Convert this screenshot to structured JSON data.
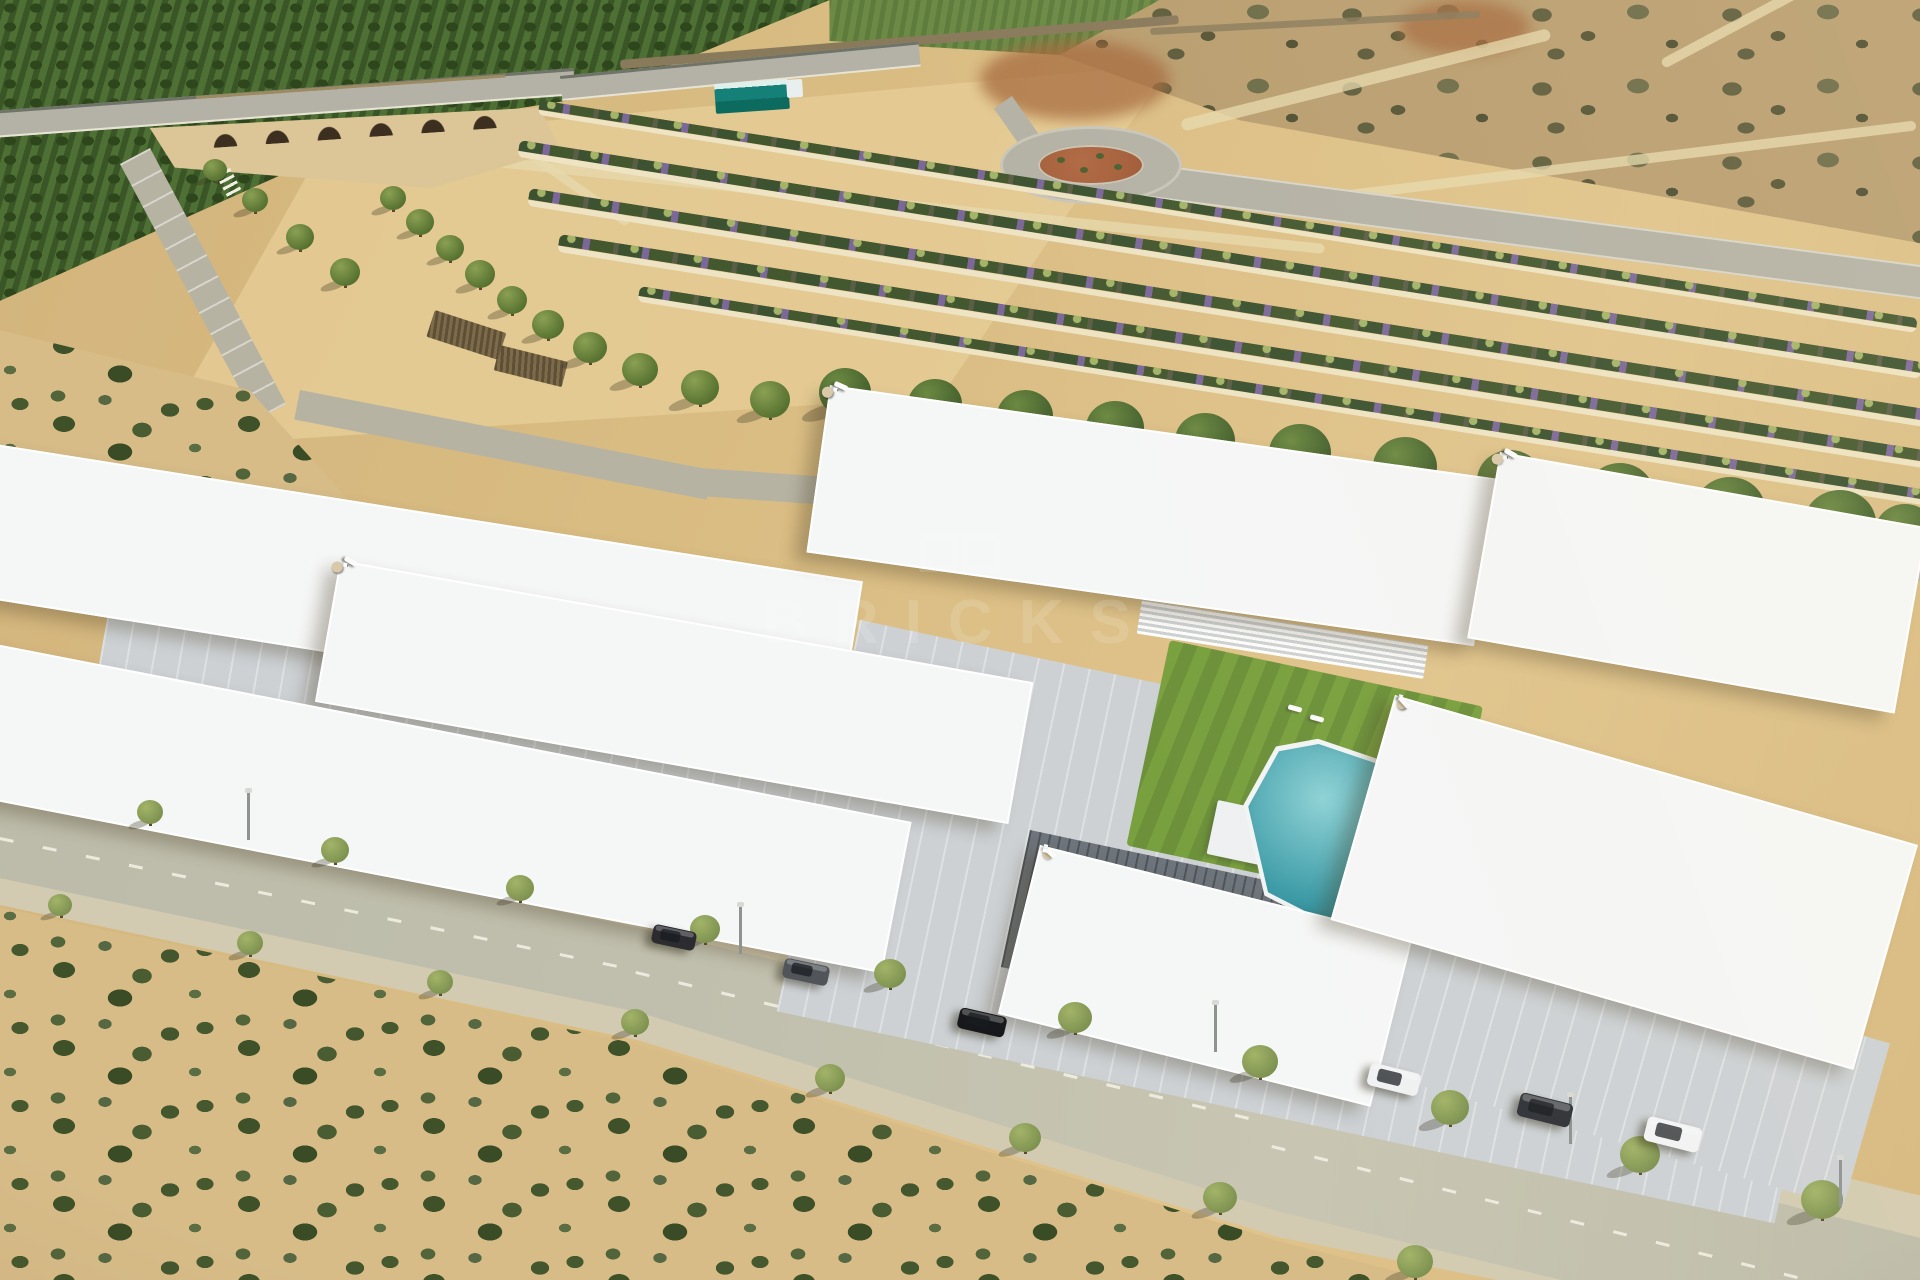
{
  "scene": {
    "type": "aerial-architectural-render",
    "description": "Aerial 3D render of a new-build white residential complex with roof terraces, communal teal pool and lawn, a tree-lined avenue with parked cars in front, sandy scrubland foreground, plowed tan fields, rows of purple flowering shrubs, an orchard hillside, a stone arched bridge and a roundabout in the background."
  },
  "watermark": {
    "text": "BRICKS"
  },
  "palette": {
    "field": "#d9bc82",
    "fieldLight": "#e6cd96",
    "trackPale": "#e7d9ae",
    "roadGray": "#b4b2a6",
    "roadAvenue": "#b6b3a3",
    "roadC": "#c0bfad",
    "sidewalk": "#d3cbb1",
    "guard": "#6f7368",
    "orchardDark": "#3a5526",
    "orchardMid": "#4f7034",
    "orchardLight": "#6c8a46",
    "scrubSand": "#d7bc88",
    "scrubBush": "#46582e",
    "drySand": "#b99e70",
    "dryBush": "#5f5e3d",
    "pine": "#44602e",
    "pineLight": "#6d8a42",
    "treeCanopy": "#7d9150",
    "treeCanopyLight": "#a3b468",
    "trunk": "#5d4a2e",
    "bwhite": "#f5f6f6",
    "roofMid": "#cdd4d9",
    "wellDark": "#747d85",
    "glass": "#414a51",
    "wood": "#a87c45",
    "parasol": "#d9c9a8",
    "poolTeal": "#3b9aa6",
    "poolTealLight": "#8ed2d6",
    "lawn": "#79a03e",
    "lawnDark": "#6c913a",
    "terracotta": "#a05a38",
    "redEarth": "#a66a3e",
    "tealDepot": "#158077",
    "stoneWall": "#8a7a5c",
    "bridge": "#c2a36b",
    "arch": "#3d2f1f",
    "ravine": "#dcc697",
    "shrubGreen": "#3c5230",
    "shrubPurple": "#7c6898",
    "pathCream": "#eee3c2"
  },
  "objects": {
    "building_rows": [
      {
        "x": -30,
        "y": 440,
        "w": 900,
        "h": 150,
        "rot": 9,
        "units": 8,
        "type": "facade"
      },
      {
        "x": 340,
        "y": 560,
        "w": 700,
        "h": 140,
        "rot": 10,
        "units": 6,
        "type": "roof"
      },
      {
        "x": -25,
        "y": 640,
        "w": 950,
        "h": 150,
        "rot": 11,
        "units": 8,
        "type": "facade"
      },
      {
        "x": 830,
        "y": 385,
        "w": 670,
        "h": 165,
        "rot": 8,
        "units": 6,
        "type": "roof"
      },
      {
        "x": 1500,
        "y": 452,
        "w": 430,
        "h": 185,
        "rot": 10,
        "units": 4,
        "type": "roof"
      },
      {
        "x": 1040,
        "y": 845,
        "w": 380,
        "h": 170,
        "rot": 14,
        "units": 3,
        "type": "facade"
      },
      {
        "x": 1395,
        "y": 695,
        "w": 540,
        "h": 230,
        "rot": 16,
        "units": 5,
        "type": "facade"
      }
    ],
    "paved": [
      {
        "x": 120,
        "y": 545,
        "w": 760,
        "h": 250,
        "rot": 10,
        "shade": "light"
      },
      {
        "x": 860,
        "y": 620,
        "w": 1020,
        "h": 400,
        "rot": 12,
        "shade": "light"
      },
      {
        "x": 1390,
        "y": 900,
        "w": 520,
        "h": 170,
        "rot": 16,
        "shade": "light"
      },
      {
        "x": 1030,
        "y": 830,
        "w": 300,
        "h": 140,
        "rot": 12,
        "shade": "dark"
      }
    ],
    "lawns": [
      {
        "x": 1170,
        "y": 640,
        "w": 320,
        "h": 210,
        "rot": 12
      }
    ],
    "fences": [
      {
        "x": 1142,
        "y": 600,
        "w": 290,
        "h": 34,
        "rot": 9
      }
    ],
    "platforms": [
      {
        "x": 1218,
        "y": 800,
        "w": 85,
        "h": 55,
        "rot": 12
      }
    ],
    "pools": [
      {
        "x": 1257,
        "y": 728,
        "w": 182,
        "h": 186,
        "rot": 10
      }
    ],
    "pool_loungers": [
      {
        "x": 1288,
        "y": 706,
        "rot": 15
      },
      {
        "x": 1310,
        "y": 716,
        "rot": 15
      },
      {
        "x": 1424,
        "y": 724,
        "rot": 15
      },
      {
        "x": 1450,
        "y": 736,
        "rot": 15
      }
    ],
    "shrub_rows": [
      {
        "x": 540,
        "y": 100,
        "len": 1395,
        "h": 15,
        "rot": 9
      },
      {
        "x": 520,
        "y": 140,
        "len": 1420,
        "h": 17,
        "rot": 9
      },
      {
        "x": 530,
        "y": 188,
        "len": 1420,
        "h": 18,
        "rot": 9
      },
      {
        "x": 560,
        "y": 234,
        "len": 1400,
        "h": 18,
        "rot": 9
      },
      {
        "x": 640,
        "y": 286,
        "len": 1320,
        "h": 16,
        "rot": 9
      }
    ],
    "pines": [
      {
        "x": 845,
        "y": 392,
        "r": 26
      },
      {
        "x": 935,
        "y": 404,
        "r": 27
      },
      {
        "x": 1025,
        "y": 416,
        "r": 28
      },
      {
        "x": 1115,
        "y": 428,
        "r": 29
      },
      {
        "x": 1205,
        "y": 441,
        "r": 30
      },
      {
        "x": 1300,
        "y": 453,
        "r": 31
      },
      {
        "x": 1405,
        "y": 467,
        "r": 32
      },
      {
        "x": 1510,
        "y": 481,
        "r": 33
      },
      {
        "x": 1620,
        "y": 495,
        "r": 34
      },
      {
        "x": 1730,
        "y": 509,
        "r": 35
      },
      {
        "x": 1840,
        "y": 523,
        "r": 36
      },
      {
        "x": 1905,
        "y": 532,
        "r": 30
      }
    ],
    "field_trees": [
      {
        "x": 215,
        "y": 170,
        "r": 12
      },
      {
        "x": 255,
        "y": 200,
        "r": 13
      },
      {
        "x": 300,
        "y": 237,
        "r": 14
      },
      {
        "x": 345,
        "y": 272,
        "r": 15
      },
      {
        "x": 393,
        "y": 198,
        "r": 13
      },
      {
        "x": 420,
        "y": 222,
        "r": 14
      },
      {
        "x": 450,
        "y": 248,
        "r": 14
      },
      {
        "x": 480,
        "y": 274,
        "r": 15
      },
      {
        "x": 512,
        "y": 300,
        "r": 15
      },
      {
        "x": 548,
        "y": 325,
        "r": 16
      },
      {
        "x": 590,
        "y": 348,
        "r": 17
      },
      {
        "x": 640,
        "y": 370,
        "r": 18
      },
      {
        "x": 700,
        "y": 388,
        "r": 19
      },
      {
        "x": 770,
        "y": 400,
        "r": 20
      }
    ],
    "street_trees": [
      {
        "x": 150,
        "y": 812,
        "r": 13
      },
      {
        "x": 335,
        "y": 850,
        "r": 14
      },
      {
        "x": 520,
        "y": 888,
        "r": 14
      },
      {
        "x": 705,
        "y": 929,
        "r": 15
      },
      {
        "x": 890,
        "y": 974,
        "r": 16
      },
      {
        "x": 1075,
        "y": 1018,
        "r": 17
      },
      {
        "x": 1260,
        "y": 1062,
        "r": 18
      },
      {
        "x": 1450,
        "y": 1108,
        "r": 19
      },
      {
        "x": 1640,
        "y": 1155,
        "r": 20
      },
      {
        "x": 1822,
        "y": 1200,
        "r": 21
      },
      {
        "x": 60,
        "y": 905,
        "r": 12
      },
      {
        "x": 250,
        "y": 943,
        "r": 13
      },
      {
        "x": 440,
        "y": 982,
        "r": 13
      },
      {
        "x": 635,
        "y": 1022,
        "r": 14
      },
      {
        "x": 830,
        "y": 1078,
        "r": 15
      },
      {
        "x": 1025,
        "y": 1138,
        "r": 16
      },
      {
        "x": 1220,
        "y": 1198,
        "r": 17
      },
      {
        "x": 1415,
        "y": 1262,
        "r": 18
      }
    ],
    "lamps": [
      {
        "x": 245,
        "y": 838
      },
      {
        "x": 737,
        "y": 952
      },
      {
        "x": 1212,
        "y": 1050
      },
      {
        "x": 1567,
        "y": 1142
      },
      {
        "x": 1837,
        "y": 1205
      }
    ],
    "cars": [
      {
        "x": 652,
        "y": 928,
        "rot": 12,
        "w": 44,
        "color": "#2b2b30",
        "kind": "dark-suv"
      },
      {
        "x": 783,
        "y": 962,
        "rot": 12,
        "w": 46,
        "color": "#515459",
        "kind": "gray-car"
      },
      {
        "x": 958,
        "y": 1012,
        "rot": 13,
        "w": 48,
        "color": "#17181b",
        "kind": "black-car"
      },
      {
        "x": 1368,
        "y": 1068,
        "rot": 14,
        "w": 52,
        "color": "#eff1f2",
        "kind": "white-hatchback"
      },
      {
        "x": 1518,
        "y": 1098,
        "rot": 14,
        "w": 54,
        "color": "#303338",
        "kind": "dark-car"
      },
      {
        "x": 1645,
        "y": 1122,
        "rot": 14,
        "w": 56,
        "color": "#f1f3f4",
        "kind": "white-suv"
      }
    ]
  }
}
